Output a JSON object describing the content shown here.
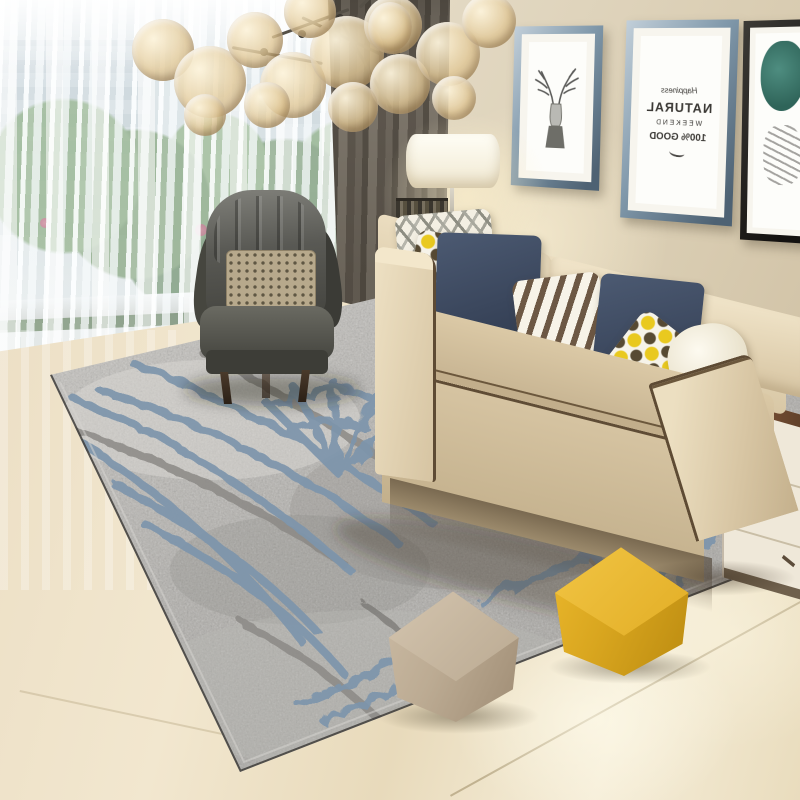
{
  "scene": {
    "title": "Living room with grey abstract area rug",
    "setting": "interior product photo",
    "objects": [
      "bubble-glass-chandelier",
      "sheer-curtains",
      "window-greenery",
      "dark-grey-curtain",
      "grey-leather-wingback-armchair",
      "beige-fabric-sofa",
      "throw-pillows",
      "floor-lamp",
      "console-table",
      "wall-art-frames",
      "side-cabinet",
      "abstract-grey-blue-rug",
      "beige-cube-pouf",
      "yellow-cube-pouf",
      "marble-floor"
    ]
  },
  "wall_art": {
    "deer_frame": {
      "subject": "deer antler line drawing"
    },
    "text_frame": {
      "mirrored": true,
      "lines": [
        "Happiness",
        "NATURAL",
        "WEEKEND",
        "100% GOOD"
      ]
    },
    "right_frame": {
      "subject": "teal abstract artwork"
    }
  },
  "palette": {
    "wall": "#e0d6c0",
    "sofa": "#d8c6a4",
    "sofa_piping": "#5e4b34",
    "armchair": "#54544e",
    "rug_base": "#b5b3af",
    "rug_blue": "#7d95ac",
    "rug_grey_line": "#8b8985",
    "pouf_yellow": "#d9a61f",
    "pouf_beige": "#bcab93",
    "pillow_navy": "#3e4a62",
    "pillow_yellow": "#e9c91f",
    "floor": "#eee2c6",
    "curtain_dark": "#5d564d",
    "greenery": "#6a9157"
  }
}
